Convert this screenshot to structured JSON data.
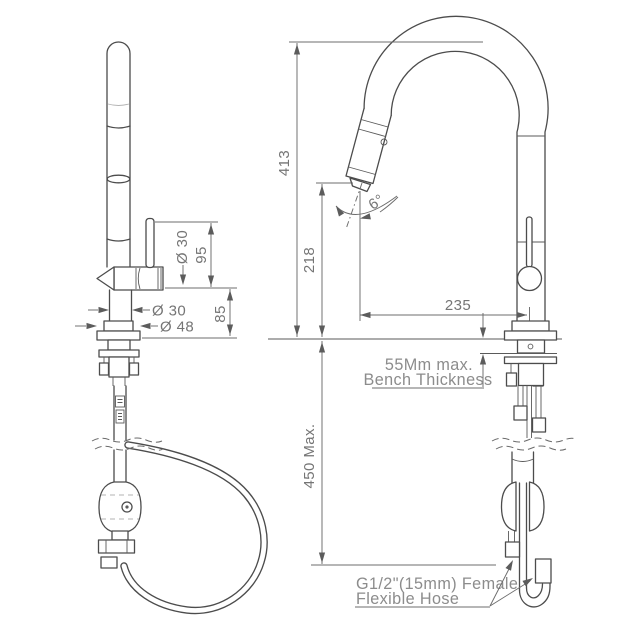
{
  "drawing": {
    "subject": "kitchen-mixer-tap-dimension-diagram",
    "colors": {
      "background": "#ffffff",
      "line": "#4c4c4c",
      "dimension_line": "#6c6c6c",
      "dimension_text": "#757575",
      "annotation_text": "#8c8c8c"
    },
    "dimensions": {
      "total_height": "413",
      "outlet_height": "218",
      "spout_reach": "235",
      "spray_angle": "6°",
      "handle_height": "95",
      "handle_diameter": "Ø 30",
      "body_height": "85",
      "body_diameter": "Ø 30",
      "base_diameter": "Ø 48",
      "hose_drop": "450 Max."
    },
    "annotations": {
      "bench_thickness_line1": "55Mm max.",
      "bench_thickness_line2": "Bench Thickness",
      "hose_line1": "G1/2\"(15mm) Female",
      "hose_line2": "Flexible Hose"
    }
  }
}
